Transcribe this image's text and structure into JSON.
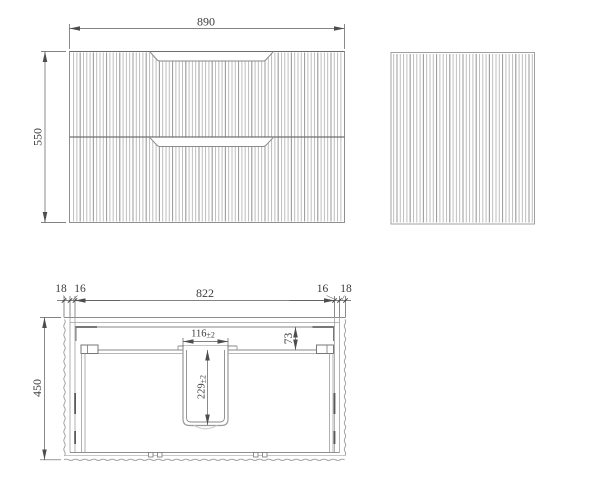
{
  "drawing": {
    "front_view": {
      "width": "890",
      "height": "550"
    },
    "side_view": {},
    "plan_view": {
      "depth": "450",
      "internal_width": "822",
      "left_side_thickness": "18",
      "left_panel_thickness": "16",
      "right_panel_thickness": "16",
      "right_side_thickness": "18",
      "cutout_width": "116",
      "cutout_width_tolerance": "±2",
      "cutout_depth": "229",
      "cutout_depth_tolerance": "±2",
      "cutout_back_offset": "73"
    },
    "colors": {
      "background": "#ffffff",
      "outline": "#8f8f8f",
      "flute": "#b6b6b6",
      "flute_accent": "#989898",
      "dimension": "#4d4d4d",
      "text": "#3c3c3c"
    }
  }
}
